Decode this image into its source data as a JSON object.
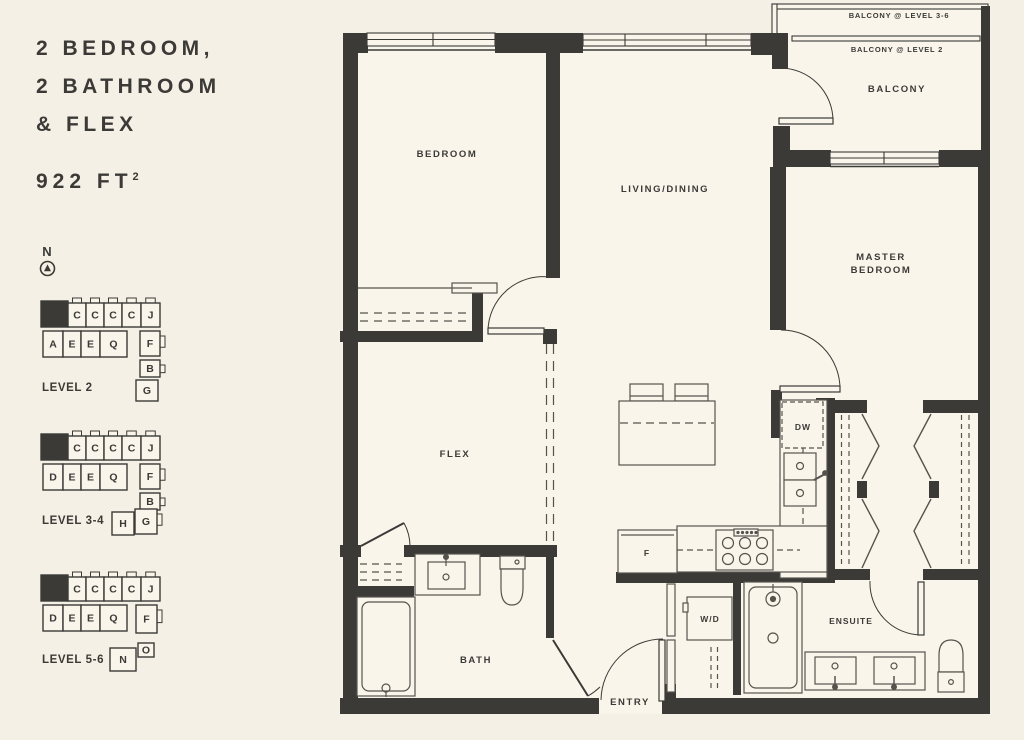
{
  "page": {
    "background": "#f5f0e5",
    "floor": "#f9f5eb",
    "ink": "#3b3a37",
    "line": "#55534d"
  },
  "header": {
    "title_lines": [
      "2 BEDROOM,",
      "2 BATHROOM",
      "& FLEX"
    ],
    "area_value": "922 FT",
    "area_sup": "2"
  },
  "compass": {
    "label": "N"
  },
  "keyplans": [
    {
      "label": "LEVEL 2",
      "label_x": 42,
      "label_y": 391,
      "units": [
        {
          "label": "L",
          "x": 41,
          "y": 301,
          "w": 27,
          "h": 26,
          "dark": true
        },
        {
          "label": "C",
          "x": 68,
          "y": 303,
          "w": 18,
          "h": 24,
          "tab": "top"
        },
        {
          "label": "C",
          "x": 86,
          "y": 303,
          "w": 18,
          "h": 24,
          "tab": "top"
        },
        {
          "label": "C",
          "x": 104,
          "y": 303,
          "w": 18,
          "h": 24,
          "tab": "top"
        },
        {
          "label": "C",
          "x": 122,
          "y": 303,
          "w": 19,
          "h": 24,
          "tab": "top"
        },
        {
          "label": "J",
          "x": 141,
          "y": 303,
          "w": 19,
          "h": 24,
          "tab": "top"
        },
        {
          "label": "A",
          "x": 43,
          "y": 331,
          "w": 20,
          "h": 26
        },
        {
          "label": "E",
          "x": 63,
          "y": 331,
          "w": 18,
          "h": 26
        },
        {
          "label": "E",
          "x": 81,
          "y": 331,
          "w": 19,
          "h": 26
        },
        {
          "label": "Q",
          "x": 100,
          "y": 331,
          "w": 27,
          "h": 26
        },
        {
          "label": "F",
          "x": 140,
          "y": 331,
          "w": 20,
          "h": 25,
          "tab": "right"
        },
        {
          "label": "B",
          "x": 140,
          "y": 360,
          "w": 20,
          "h": 17,
          "tab": "right"
        },
        {
          "label": "G",
          "x": 136,
          "y": 380,
          "w": 22,
          "h": 21
        }
      ]
    },
    {
      "label": "LEVEL 3-4",
      "label_x": 42,
      "label_y": 524,
      "units": [
        {
          "label": "L",
          "x": 41,
          "y": 434,
          "w": 27,
          "h": 26,
          "dark": true
        },
        {
          "label": "C",
          "x": 68,
          "y": 436,
          "w": 18,
          "h": 24,
          "tab": "top"
        },
        {
          "label": "C",
          "x": 86,
          "y": 436,
          "w": 18,
          "h": 24,
          "tab": "top"
        },
        {
          "label": "C",
          "x": 104,
          "y": 436,
          "w": 18,
          "h": 24,
          "tab": "top"
        },
        {
          "label": "C",
          "x": 122,
          "y": 436,
          "w": 19,
          "h": 24,
          "tab": "top"
        },
        {
          "label": "J",
          "x": 141,
          "y": 436,
          "w": 19,
          "h": 24,
          "tab": "top"
        },
        {
          "label": "D",
          "x": 43,
          "y": 464,
          "w": 20,
          "h": 26
        },
        {
          "label": "E",
          "x": 63,
          "y": 464,
          "w": 18,
          "h": 26
        },
        {
          "label": "E",
          "x": 81,
          "y": 464,
          "w": 19,
          "h": 26
        },
        {
          "label": "Q",
          "x": 100,
          "y": 464,
          "w": 27,
          "h": 26
        },
        {
          "label": "F",
          "x": 140,
          "y": 464,
          "w": 20,
          "h": 25,
          "tab": "right"
        },
        {
          "label": "B",
          "x": 140,
          "y": 493,
          "w": 20,
          "h": 17,
          "tab": "right"
        },
        {
          "label": "H",
          "x": 112,
          "y": 512,
          "w": 22,
          "h": 23
        },
        {
          "label": "G",
          "x": 135,
          "y": 509,
          "w": 22,
          "h": 25,
          "tab": "right"
        }
      ]
    },
    {
      "label": "LEVEL 5-6",
      "label_x": 42,
      "label_y": 663,
      "units": [
        {
          "label": "L",
          "x": 41,
          "y": 575,
          "w": 27,
          "h": 26,
          "dark": true
        },
        {
          "label": "C",
          "x": 68,
          "y": 577,
          "w": 18,
          "h": 24,
          "tab": "top"
        },
        {
          "label": "C",
          "x": 86,
          "y": 577,
          "w": 18,
          "h": 24,
          "tab": "top"
        },
        {
          "label": "C",
          "x": 104,
          "y": 577,
          "w": 18,
          "h": 24,
          "tab": "top"
        },
        {
          "label": "C",
          "x": 122,
          "y": 577,
          "w": 19,
          "h": 24,
          "tab": "top"
        },
        {
          "label": "J",
          "x": 141,
          "y": 577,
          "w": 19,
          "h": 24,
          "tab": "top"
        },
        {
          "label": "D",
          "x": 43,
          "y": 605,
          "w": 20,
          "h": 26
        },
        {
          "label": "E",
          "x": 63,
          "y": 605,
          "w": 18,
          "h": 26
        },
        {
          "label": "E",
          "x": 81,
          "y": 605,
          "w": 19,
          "h": 26
        },
        {
          "label": "Q",
          "x": 100,
          "y": 605,
          "w": 27,
          "h": 26
        },
        {
          "label": "F",
          "x": 136,
          "y": 605,
          "w": 21,
          "h": 28,
          "tab": "right"
        },
        {
          "label": "O",
          "x": 138,
          "y": 643,
          "w": 16,
          "h": 14
        },
        {
          "label": "N",
          "x": 110,
          "y": 648,
          "w": 26,
          "h": 23
        }
      ]
    }
  ],
  "plan": {
    "labels": {
      "bedroom": "BEDROOM",
      "living": "LIVING/DINING",
      "master_line1": "MASTER",
      "master_line2": "BEDROOM",
      "balcony": "BALCONY",
      "balcony_l36": "BALCONY @ LEVEL 3-6",
      "balcony_l2": "BALCONY @ LEVEL 2",
      "flex": "FLEX",
      "bath": "BATH",
      "entry": "ENTRY",
      "ensuite": "ENSUITE",
      "wd": "W/D",
      "dw": "DW",
      "fridge": "F"
    }
  }
}
